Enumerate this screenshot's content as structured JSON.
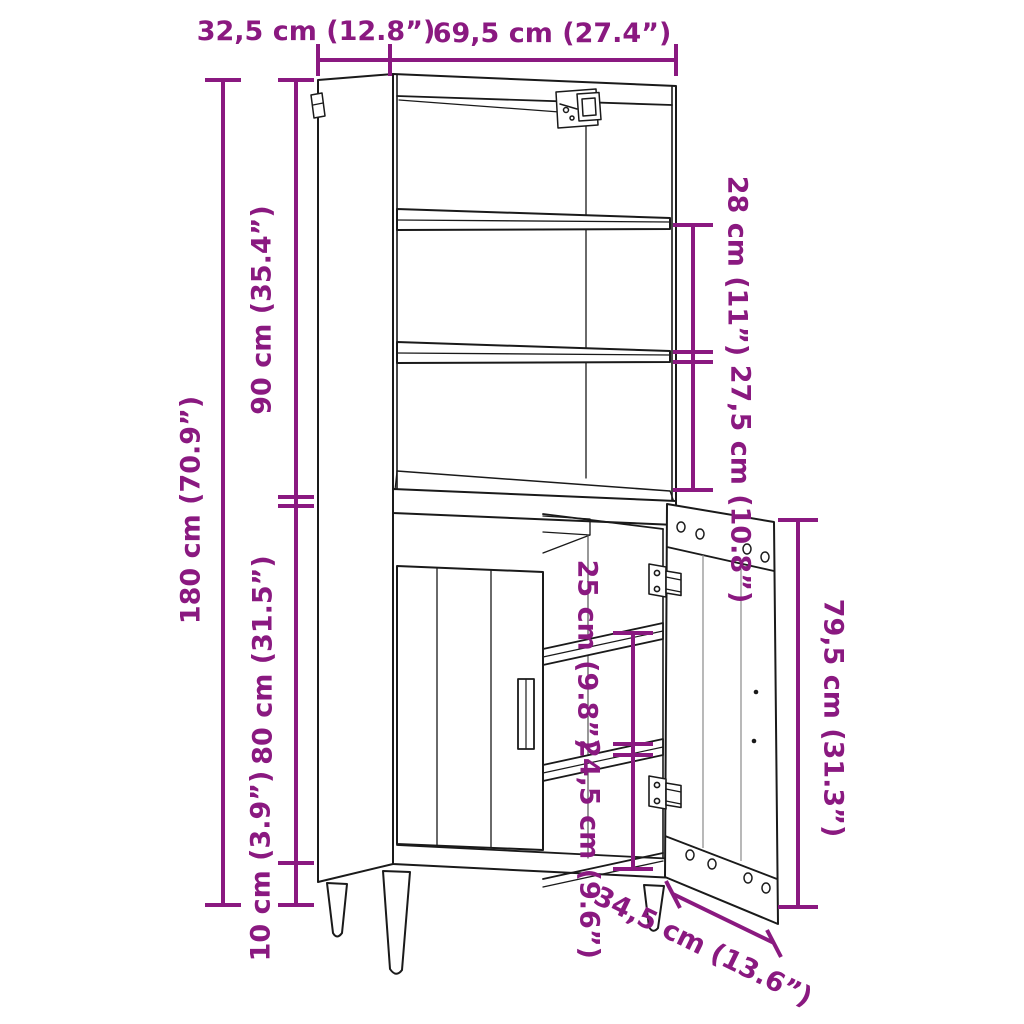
{
  "figure": {
    "type": "furniture-dimension-diagram",
    "subject": "Tall highboard cabinet: open upper shelving unit, lower two-door cupboard with right door open, tapered legs",
    "accent_color": "#8a1980",
    "line_color": "#1a1a1a",
    "background_color": "#ffffff"
  },
  "dimensions": {
    "depth": {
      "label": "32,5 cm (12.8”)",
      "cm": 32.5,
      "inches": 12.8
    },
    "width": {
      "label": "69,5 cm (27.4”)",
      "cm": 69.5,
      "inches": 27.4
    },
    "height_total": {
      "label": "180 cm (70.9”)",
      "cm": 180,
      "inches": 70.9
    },
    "height_upper": {
      "label": "90 cm (35.4”)",
      "cm": 90,
      "inches": 35.4
    },
    "height_lower": {
      "label": "80 cm (31.5”)",
      "cm": 80,
      "inches": 31.5
    },
    "height_legs": {
      "label": "10 cm (3.9”)",
      "cm": 10,
      "inches": 3.9
    },
    "gap_upper_shelf": {
      "label": "28 cm (11”)",
      "cm": 28,
      "inches": 11
    },
    "gap_upper_bottom": {
      "label": "27,5 cm (10.8”)",
      "cm": 27.5,
      "inches": 10.8
    },
    "gap_lower_shelf": {
      "label": "25 cm (9.8”)",
      "cm": 25,
      "inches": 9.8
    },
    "gap_lower_bottom": {
      "label": "24,5 cm (9.6”)",
      "cm": 24.5,
      "inches": 9.6
    },
    "door_height": {
      "label": "79,5 cm (31.3”)",
      "cm": 79.5,
      "inches": 31.3
    },
    "door_width": {
      "label": "34,5 cm (13.6”)",
      "cm": 34.5,
      "inches": 13.6
    }
  }
}
